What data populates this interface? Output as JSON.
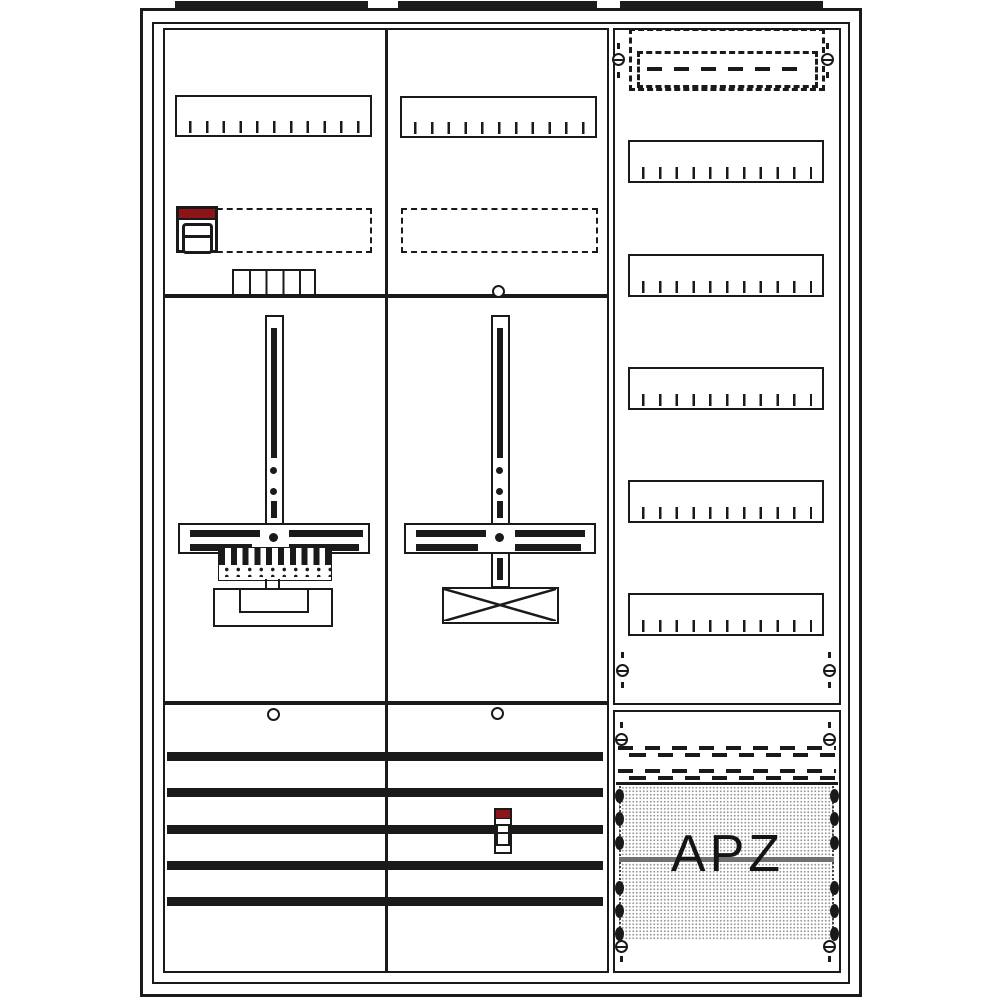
{
  "diagram": {
    "apz_label": "APZ",
    "colors": {
      "line": "#1a1a1a",
      "accent_red": "#8b1518",
      "texture_dot": "#9a9a9a",
      "apz_divider_gray": "#707070",
      "background": "#ffffff"
    },
    "counts": {
      "top_mounting_tabs": 3,
      "columns": 3,
      "upper_field_rails": 2,
      "right_column_rails": 5,
      "ticks_per_rail": 11,
      "meter_mounting_plates": 2,
      "busbars": 5,
      "terminal_block_cells": 5,
      "breaker_symbols": 2,
      "screws": 8,
      "apz_side_clips_per_side": 6
    }
  }
}
